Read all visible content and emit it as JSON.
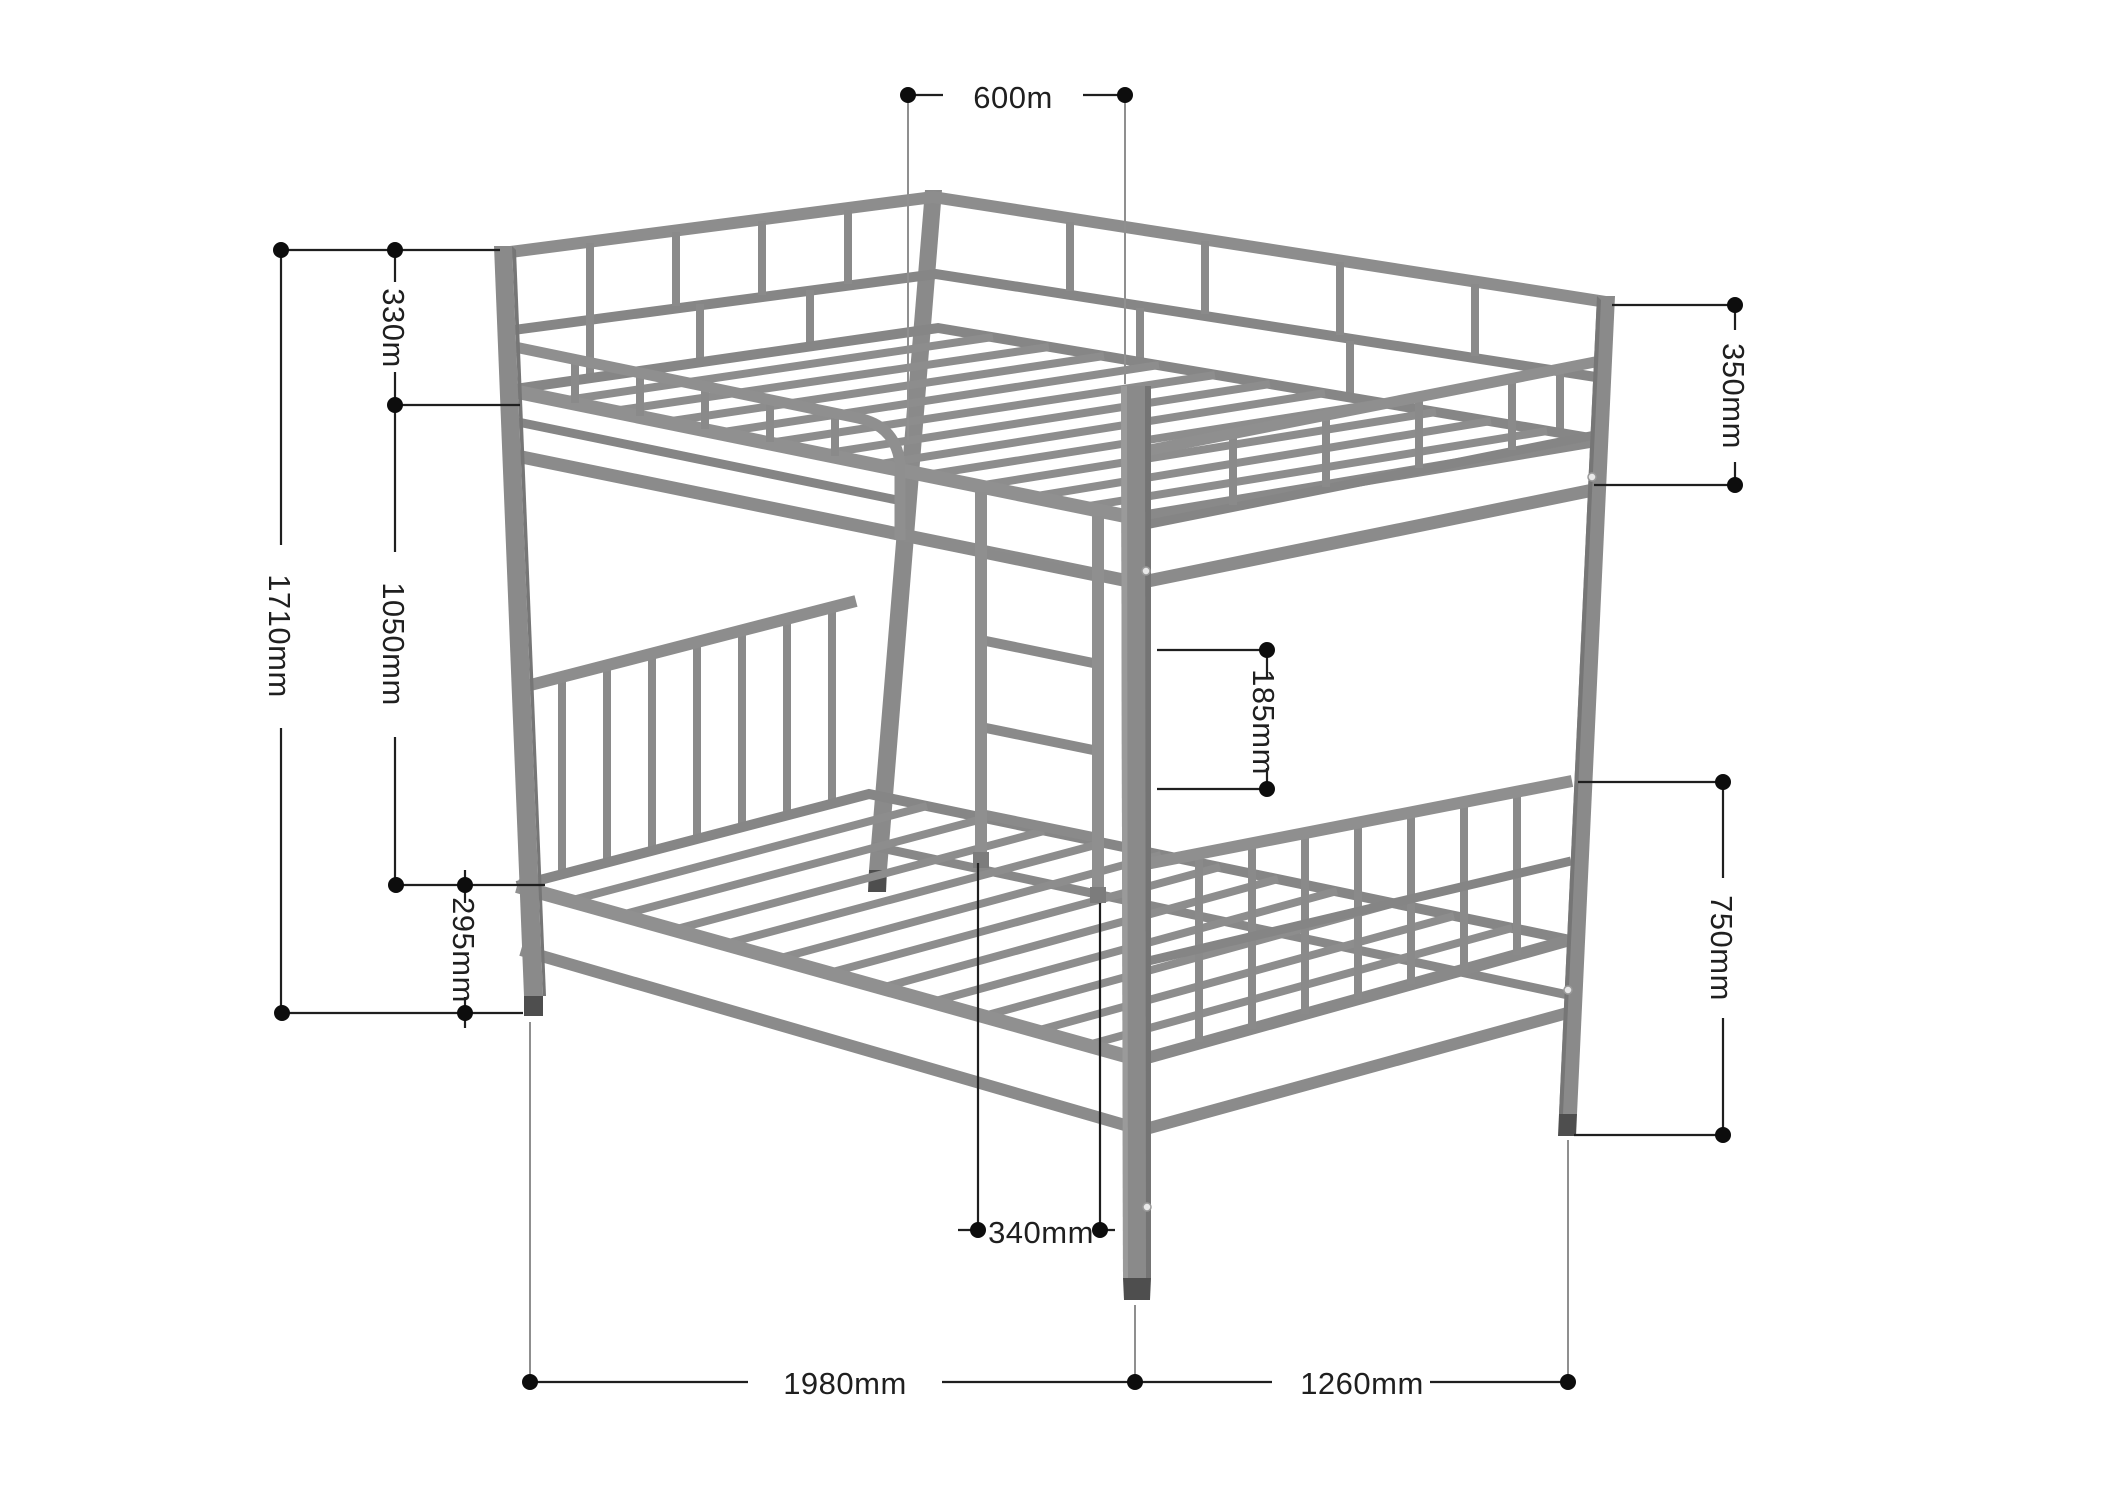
{
  "diagram": {
    "type": "furniture-dimension-drawing",
    "subject": "metal bunk bed isometric view",
    "units": "mm",
    "colors": {
      "frame": "#8d8d8d",
      "frame_mid": "#858585",
      "frame_dark": "#7a7a7a",
      "foot": "#4e4e4e",
      "dimension_line": "#1f1f1f",
      "extension_line": "#8f8f8f",
      "background": "#ffffff"
    },
    "dimensions": [
      {
        "id": "top-opening-width",
        "label": "600m",
        "orientation": "horizontal",
        "measures": "guardrail opening width at top bunk"
      },
      {
        "id": "guardrail-height",
        "label": "330m",
        "orientation": "vertical",
        "measures": "upper guardrail height above platform"
      },
      {
        "id": "overall-height",
        "label": "1710mm",
        "orientation": "vertical",
        "measures": "overall bed height"
      },
      {
        "id": "bunk-gap-height",
        "label": "1050mm",
        "orientation": "vertical",
        "measures": "upper platform to lower platform"
      },
      {
        "id": "lower-platform-height",
        "label": "295mm",
        "orientation": "vertical",
        "measures": "lower platform height above floor"
      },
      {
        "id": "rail-gap",
        "label": "185mm",
        "orientation": "vertical",
        "measures": "gap between upper rail and lower footboard rail"
      },
      {
        "id": "upper-rail-height",
        "label": "350mm",
        "orientation": "vertical",
        "measures": "right post top to upper frame rail"
      },
      {
        "id": "footboard-height",
        "label": "750mm",
        "orientation": "vertical",
        "measures": "lower footboard rail height above floor"
      },
      {
        "id": "ladder-width",
        "label": "340mm",
        "orientation": "horizontal",
        "measures": "ladder width"
      },
      {
        "id": "bed-length",
        "label": "1980mm",
        "orientation": "horizontal",
        "measures": "overall bed length"
      },
      {
        "id": "bed-width",
        "label": "1260mm",
        "orientation": "horizontal",
        "measures": "overall bed width"
      }
    ]
  }
}
